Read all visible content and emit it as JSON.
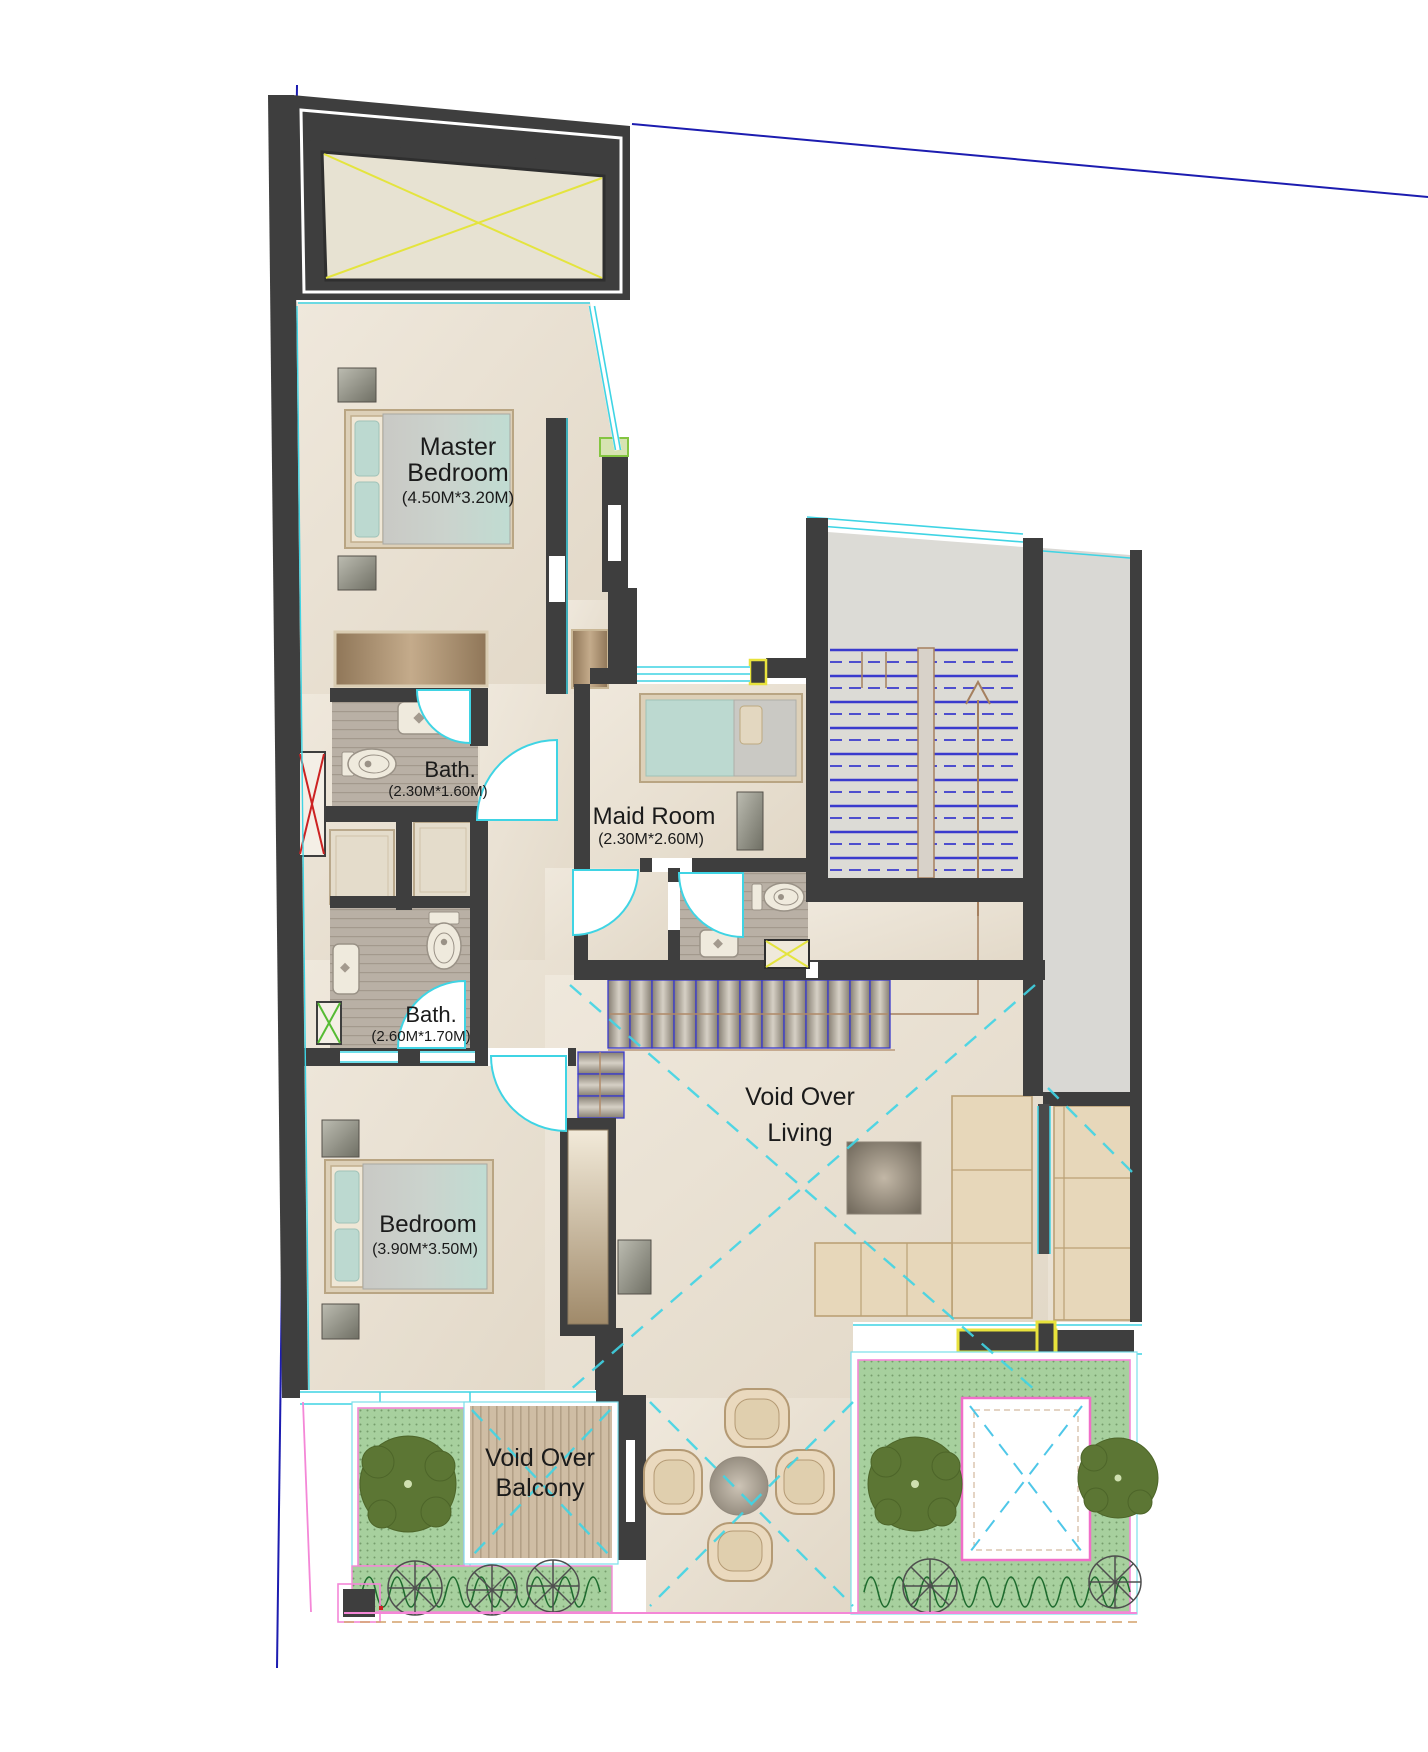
{
  "plan": {
    "type": "apartment-upper-floor-plan",
    "rooms": {
      "master_bedroom": {
        "label_line1": "Master",
        "label_line2": "Bedroom",
        "dimensions": "(4.50M*3.20M)"
      },
      "bath_master": {
        "label": "Bath.",
        "dimensions": "(2.30M*1.60M)"
      },
      "maid_room": {
        "label": "Maid Room",
        "dimensions": "(2.30M*2.60M)"
      },
      "bath_shared": {
        "label": "Bath.",
        "dimensions": "(2.60M*1.70M)"
      },
      "bedroom": {
        "label": "Bedroom",
        "dimensions": "(3.90M*3.50M)"
      },
      "void_over_living": {
        "label_line1": "Void Over",
        "label_line2": "Living"
      },
      "void_over_balcony": {
        "label_line1": "Void Over",
        "label_line2": "Balcony"
      }
    },
    "colors": {
      "wall": "#3e3e3e",
      "floor_beige": "#e9e1d3",
      "bath_wood": "#b9b0a5",
      "stair_gray": "#dcdbd6",
      "boundary_blue": "#1c1cb0",
      "glazing_cyan": "#3fd4e4",
      "void_dash_cyan": "#3fd4e4",
      "terrace_pink": "#f487d7",
      "shaft_yellow": "#e8e23c",
      "stair_tread_blue": "#3a3acd",
      "greenery": "#a7d09e",
      "tree_green": "#5c7634",
      "bed_teal": "#bcd9d0",
      "sofa_tan": "#e7d7ba",
      "red_shaft_x": "#cc2222",
      "green_shaft_x": "#55bb33"
    }
  }
}
